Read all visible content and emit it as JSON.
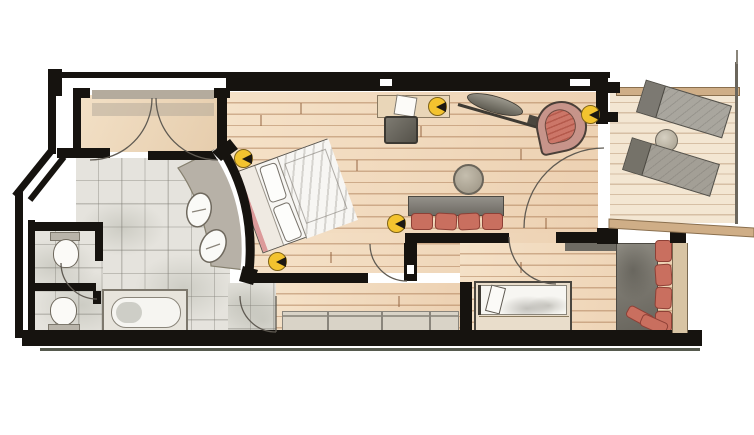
{
  "meta": {
    "kind": "hand-drawn watercolor floor plan of a hotel suite",
    "visible_text": "none",
    "canvas": {
      "width": 754,
      "height": 435
    }
  },
  "palette": {
    "paper": "#ffffff",
    "wall_black": "#16130f",
    "wood_floor": "#f2dcc2",
    "wood_line": "#a37048",
    "balcony_floor": "#f3e6d2",
    "tile_floor": "#e5e3dd",
    "hall_floor": "#ecd8bd",
    "vanity_gray": "#b7b1a7",
    "accent_red": "#c96f5f",
    "chair_ring": "#c7948a",
    "lamp_yellow": "#f3c32f",
    "lounger_gray": "#a9a69e",
    "bench_gray": "#d9d3c7",
    "parapet_tan": "#cfae87",
    "headboard_pink": "#dc9a9a"
  },
  "rooms": [
    {
      "name": "entry-hall",
      "floor": "beige wash"
    },
    {
      "name": "bathroom",
      "floor": "gray tiles",
      "fixtures": [
        "curved vanity with two sinks",
        "bathtub"
      ]
    },
    {
      "name": "wc-compartments",
      "floor": "gray tiles",
      "fixtures": [
        "toilet upper",
        "toilet lower"
      ]
    },
    {
      "name": "bedroom-living",
      "floor": "wood planks",
      "furniture": [
        "double bed angled against curved wall",
        "desk with chair and paper",
        "wall tv on swivel arm",
        "red shell armchair",
        "round table",
        "sofa with red cushions"
      ]
    },
    {
      "name": "lower-passage",
      "furniture": [
        "long low bench"
      ]
    },
    {
      "name": "kids-room",
      "furniture": [
        "single bed with pillow",
        "gray corner seat with red cushions"
      ]
    },
    {
      "name": "balcony",
      "floor": "light wood planks",
      "furniture": [
        "sun lounger upper",
        "sun lounger lower",
        "small round table"
      ]
    }
  ],
  "fixtures": {
    "door_arcs": 7,
    "bedside_lamps": 2,
    "floor_lamps": 3,
    "windows_in_top_wall": 2,
    "curved_wall": "double-line arc between vanity and bed"
  }
}
